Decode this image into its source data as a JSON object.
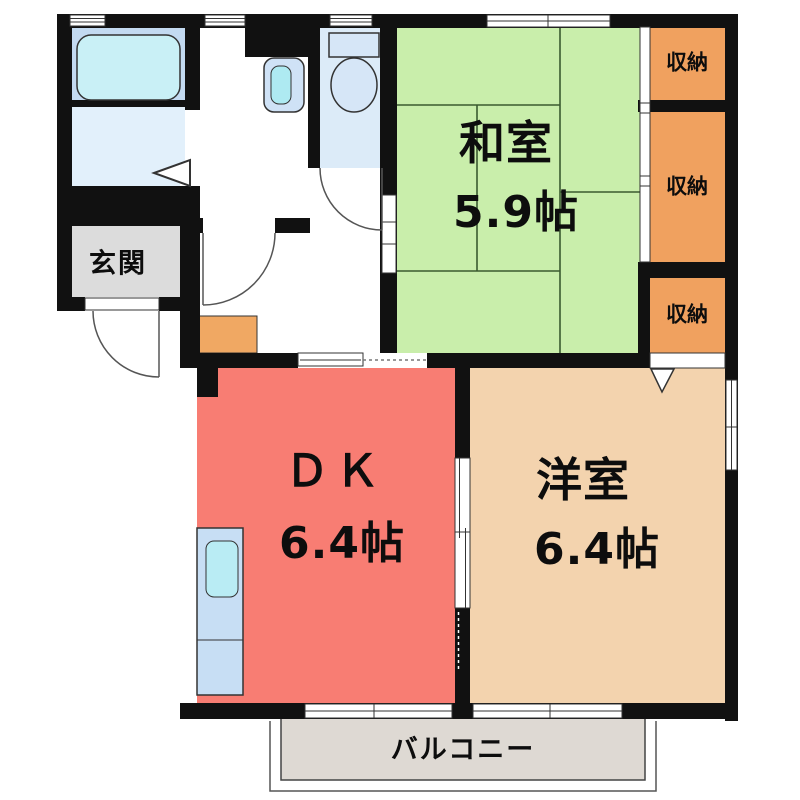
{
  "plan": {
    "type": "apartment-floor-plan",
    "rooms": {
      "entrance": {
        "label": "玄関"
      },
      "washitsu": {
        "label": "和室",
        "size": "5.9帖"
      },
      "dk": {
        "label": "ＤＫ",
        "size": "6.4帖"
      },
      "yoshitsu": {
        "label": "洋室",
        "size": "6.4帖"
      },
      "closet1": {
        "label": "収納"
      },
      "closet2": {
        "label": "収納"
      },
      "closet3": {
        "label": "収納"
      },
      "balcony": {
        "label": "バルコニー"
      }
    },
    "fixtures": [
      "bathtub-icon",
      "washbasin-icon",
      "toilet-icon",
      "kitchen-sink-icon",
      "shoe-cabinet-icon"
    ],
    "colors": {
      "wall": "#111111",
      "washitsu_green": "#c9eeab",
      "closet_orange": "#f0a15f",
      "dk_red": "#f87d73",
      "yoshitsu_beige": "#f3d3ae",
      "genkan_gray": "#dcdcdc",
      "balcony_gray": "#ded9d3",
      "bath_zone_blue": "#c3daf1",
      "bath_floor_blue": "#e2f0fb",
      "toilet_floor_blue": "#dcebf8",
      "fixture_blue": "#cfe2f6",
      "water_cyan": "#c9f0f6",
      "shoebox_orange": "#f0a863"
    }
  }
}
